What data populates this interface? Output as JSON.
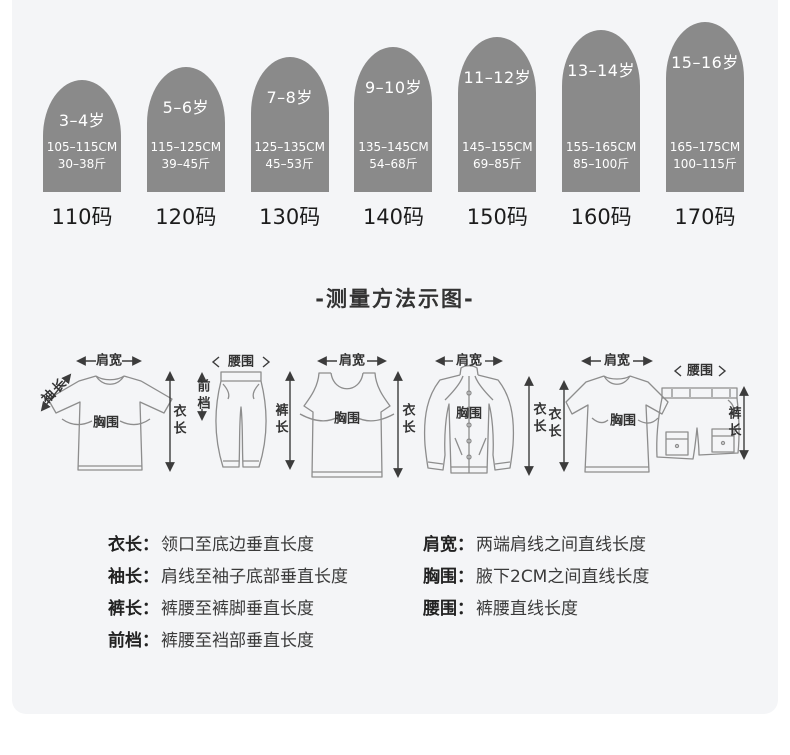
{
  "size_chart": {
    "items": [
      {
        "age": "3–4岁",
        "height_cm": "105–115CM",
        "weight": "30–38斤",
        "code": "110码"
      },
      {
        "age": "5–6岁",
        "height_cm": "115–125CM",
        "weight": "39–45斤",
        "code": "120码"
      },
      {
        "age": "7–8岁",
        "height_cm": "125–135CM",
        "weight": "45–53斤",
        "code": "130码"
      },
      {
        "age": "9–10岁",
        "height_cm": "135–145CM",
        "weight": "54–68斤",
        "code": "140码"
      },
      {
        "age": "11–12岁",
        "height_cm": "145–155CM",
        "weight": "69–85斤",
        "code": "150码"
      },
      {
        "age": "13–14岁",
        "height_cm": "155–165CM",
        "weight": "85–100斤",
        "code": "160码"
      },
      {
        "age": "15–16岁",
        "height_cm": "165–175CM",
        "weight": "100–115斤",
        "code": "170码"
      }
    ],
    "arch_color": "#8a8a8a",
    "card_color": "#f4f5f7"
  },
  "measure": {
    "title": "-测量方法示图-",
    "labels": {
      "shoulder": "肩宽",
      "sleeve": "袖长",
      "chest": "胸围",
      "length": "衣长",
      "waist": "腰围",
      "front_rise": "前档",
      "pants_length": "裤长"
    }
  },
  "definitions": {
    "colon": "：",
    "left": [
      {
        "term": "衣长",
        "desc": "领口至底边垂直长度"
      },
      {
        "term": "袖长",
        "desc": "肩线至袖子底部垂直长度"
      },
      {
        "term": "裤长",
        "desc": "裤腰至裤脚垂直长度"
      },
      {
        "term": "前档",
        "desc": "裤腰至裆部垂直长度"
      }
    ],
    "right": [
      {
        "term": "肩宽",
        "desc": "两端肩线之间直线长度"
      },
      {
        "term": "胸围",
        "desc": "腋下2CM之间直线长度"
      },
      {
        "term": "腰围",
        "desc": "裤腰直线长度"
      }
    ]
  }
}
